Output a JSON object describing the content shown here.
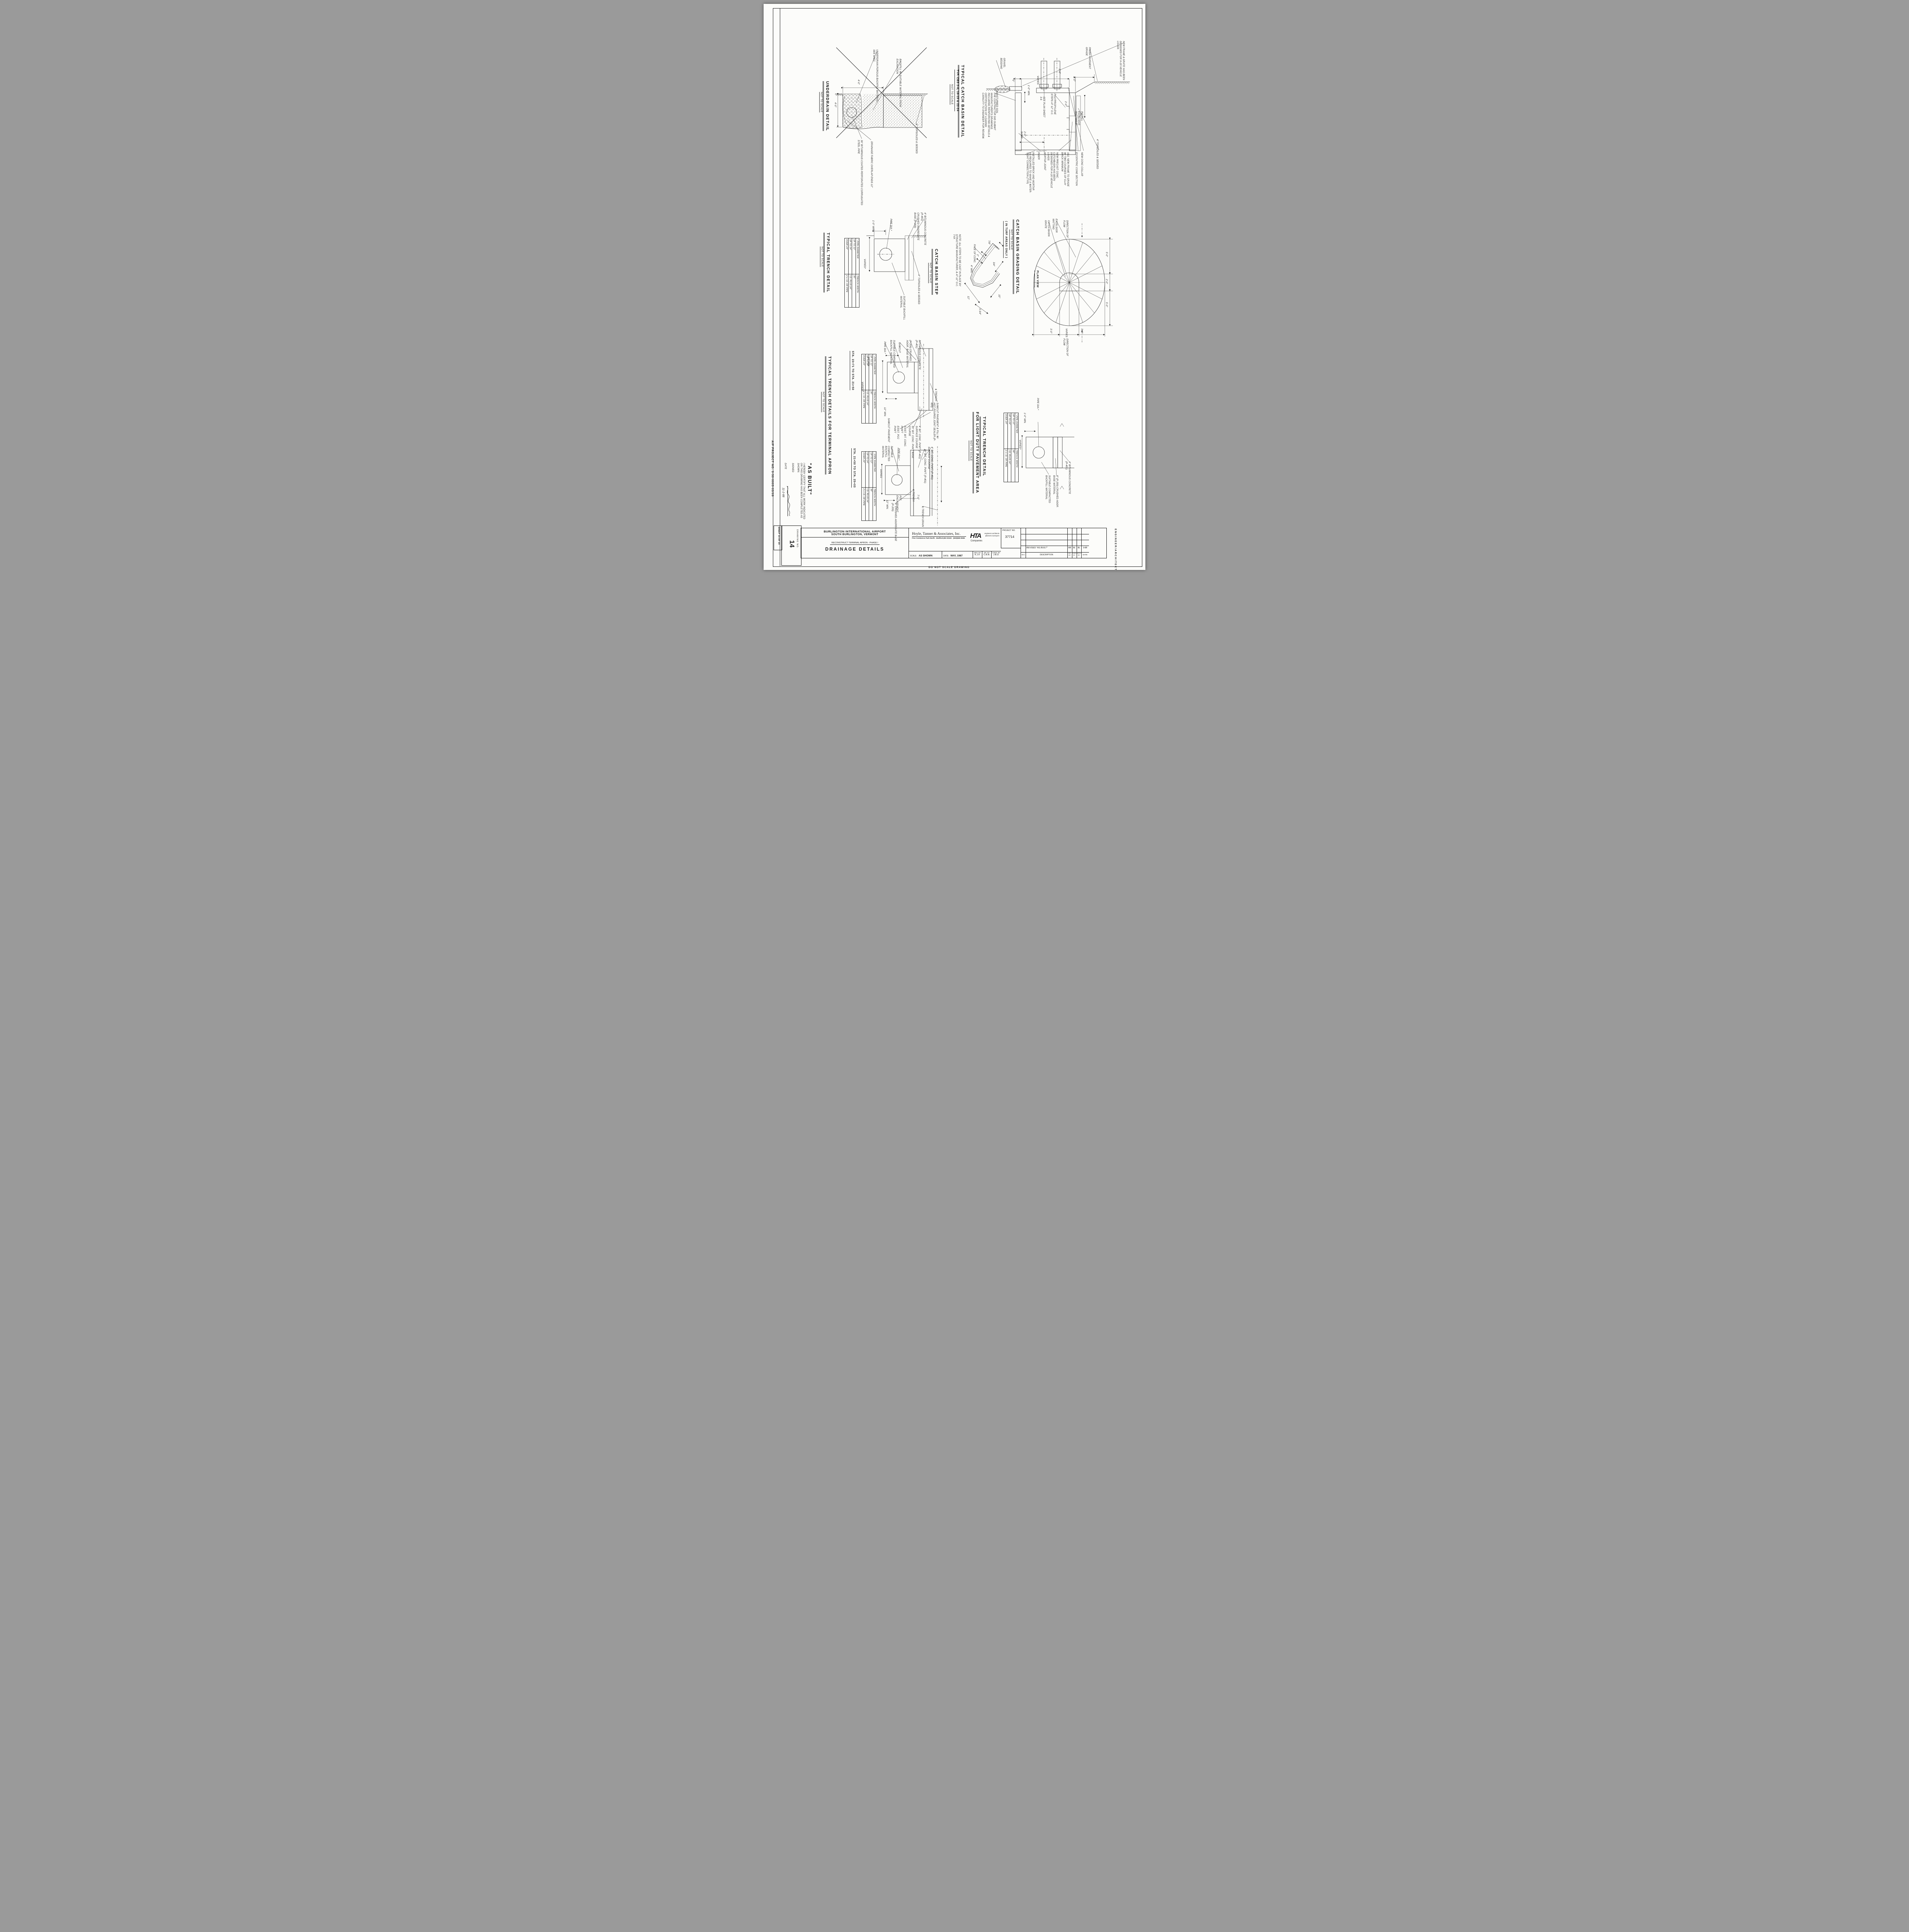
{
  "sheet": {
    "do_not_scale": "DO NOT SCALE DRAWING",
    "engineer_architect": "ENGINEER/ARCHITECT",
    "aip_project_no": "AIP PROJECT NO. 3-50-0005-03/09",
    "sheet_no": "SHEET 14 OF 23",
    "drawing_no_label": "DRAWING NO.",
    "drawing_no": "14"
  },
  "title_block": {
    "owner_line1": "BURLINGTON INTERNATIONAL AIRPORT",
    "owner_line2": "SOUTH BURLINGTON, VERMONT",
    "project": "RECONSTRUCT TERMINAL APRON - PHASE I",
    "sheet_title": "DRAINAGE DETAILS",
    "firm_name": "Hoyle, Tanner & Associates, Inc.",
    "firm_address": "Five Commerce Park North · Bedford,NH 03102 · (603)669-5555",
    "logo": "HTA",
    "logo_sub": "Companies",
    "services": "engineers architects planners surveyors",
    "scale_label": "SCALE:",
    "scale_value": "AS SHOWN",
    "date_label": "DATE:",
    "date_value": "MAY, 1987",
    "des_label": "DES. BY",
    "des_value": "K.J.F.",
    "dr_label": "DR. BY",
    "dr_value": "C.B.B.",
    "chkd_label": "CHKD. BY",
    "chkd_value": "J.B.D.",
    "project_no_label": "PROJECT NO.",
    "project_no": "37714",
    "rev_entry": {
      "rev": "",
      "description": "REVISED \"AS BUILT\"",
      "dr": "RB",
      "chkd": "BL",
      "appd": "BL",
      "date": "9-88"
    },
    "rev_headers": {
      "rev": "REV.",
      "description": "DESCRIPTION",
      "dr": "DR. BY",
      "chkd": "CHKD. BY",
      "appd": "APPD. BY",
      "date": "DATE"
    }
  },
  "as_built": {
    "heading": "\"AS BUILT\"",
    "certification": "I HEREBY CERTIFY THAT ALL WORK INDICATED ON THIS DRAWING HAS BEEN COMPLETED AS SHOWN.",
    "signed_label": "SIGNED",
    "date_label": "DATE",
    "date_value": "11-2-88"
  },
  "trench_table": {
    "star": "*",
    "col_pipe": "PIPE DIAMETER",
    "col_width": "TRENCH WIDTH",
    "rows": [
      [
        "UP TO 12\"",
        "36\""
      ],
      [
        "UP TO 24\"",
        "I.D. PLUS 24\""
      ],
      [
        "OVER 24\"",
        "2 x I.D. OF PIPE"
      ]
    ]
  },
  "underdrain": {
    "title": "UNDERDRAIN DETAIL",
    "scale_note": "NOT TO SCALE",
    "labels": {
      "porous_backfill": "UNDERDRAIN POROUS BACKFILL MATERIAL, SEE SPEC.",
      "suitable_backfill": "BACKFILL W/ SUITABLE MATERIAL FROM EXCAVATION",
      "pipe": "36\" BITUMINOUS COATED PERFORATED CORRUGATED STEEL PIPE",
      "fabric": "DRAINAGE FABRIC OVERLAP ENDS 12\"",
      "topsoil": "4\" TOPSOILED & SEEDED",
      "dim_width": "4'-0\"",
      "dim_depth": "4'-0\""
    }
  },
  "catch_basin": {
    "title": "TYPICAL CATCH BASIN DETAIL",
    "subtitle": "TYP. CBS 2-6, 16-19 & 22-24",
    "scale_note": "NOT TO SCALE",
    "note": "THE CONTRACTOR DID SUBMIT MANUFACTURER'S DRAWINGS INCLUDING REINFORCING DETAILS & CERTIFICATION OF LOADING CAPACITY TO ENGINEER FOR REVIEW.",
    "labels": {
      "gravel_bedding": "GRAVEL BEDDING",
      "undisturbed_soil": "UNDISTURBED SOIL",
      "finish_grade": "FINISH PAVEMENT GRADE",
      "new_frame": "NEW FRAME & GRATE HAS BEEN DESIGNED FOR H-20 VEHICLE LOADS",
      "install_matting": "INSTALL EXCELSIOR MATTING 3\"",
      "see_plan": "SEE PLAN SHEET 3-6",
      "steps": "POLYPROPYLENE STEPS AT 12\" O.C.",
      "installed_brick": "INSTALLED BRICK AND MORTAR AS REQUIRED TO MAKE A WATER-TIGHT CONNECTION (TYP)",
      "riser": "RISER",
      "mortar_joint": "MORTAR JOINT",
      "precast": "NEW PRECAST CONC. CATCHBASIN HAS BEEN DESIGNED FOR H-20 VEHICLE LOADS",
      "adj_frame": "ADJ. NEW FRAME TO GRADE W/ TWO COURSES OF CLAY BRICK MINIMUM",
      "eccentric": "ECCENTRIC CONE SECTION",
      "collar": "NEW CONC COLLAR",
      "topsoil": "4\" TOPSOILED & SEEDED",
      "dim_5": "5\"",
      "dim_varies": "VARIES",
      "dim_2_6": "2'-6\"",
      "dim_1_0_min": "1'-0\" MIN.",
      "dim_1_0": "1'-0\"",
      "dim_2_0": "2'-0\"",
      "dim_sump": "2'-0\" SUMP"
    }
  },
  "trench_detail": {
    "title": "TYPICAL TRENCH DETAIL",
    "scale_note": "NOT TO SCALE",
    "labels": {
      "pipe_dia": "PIPE DIA.*",
      "min": "1'-0\" MIN.",
      "varies": "VARIES*",
      "backfill": "SUITABLE BACKFILL MATERIAL",
      "topsoil": "4\" TOPSOILED & SEEDED",
      "bituminous": "4\" BITUMINOUS CONCRETE (P-401)",
      "aggregate": "CRUSHED AGGREGATE BASE (P-209)"
    }
  },
  "cb_step": {
    "title": "CATCH BASIN STEP",
    "scale_note": "NOT TO SCALE",
    "note": "NOTE: ALL STEPS TO BE CAST IN PLACE BY STRUCTURE MANUFACTURER, & AT 12\" O.C. TYP.",
    "labels": {
      "face": "FACE OF CONC.",
      "d1": "7/8\"",
      "d2": "2\"",
      "d3": "4\" MIN.",
      "d4": "3/4\"",
      "d5": "12\"",
      "d6": "3 3/4\"",
      "d7": "10\""
    }
  },
  "cb_grading": {
    "title": "CATCH BASIN GRADING DETAIL",
    "scale_note": "NOT TO SCALE",
    "subtitle": "( IN TURF AREAS ONLY )",
    "labels": {
      "grate": "CATCH BASIN GRATE",
      "matting": "EXCELSIOR MATTING",
      "flow_top": "DIRECTION OF FLOW",
      "flow_bottom": "DIRECTION OF FLOW",
      "plan_view": "PLAN VIEW",
      "dim_5a": "5'-0\"",
      "dim_2": "2'-0\"",
      "dim_5b": "5'-0\"",
      "dim_3a": "3'-0\"",
      "dim_varies": "VARIES",
      "dim_3b": "3'-0\""
    }
  },
  "apron": {
    "title": "TYPICAL TRENCH DETAILS FOR TERMINAL APRON",
    "scale_note": "NOT TO SCALE",
    "sta1": "STA. 15+71 TO STA. 21+50",
    "sta2": "STA. 21+50 TO STA. 25+03",
    "labels_a": {
      "min12": "12\" MIN.",
      "min12b": "12\" MIN.",
      "varies": "VARIES*",
      "pipe_dia": "PIPE DIA.*",
      "backfill": "SUITABLE COMPACTED BACKFILL MATERIAL",
      "sawcut": "SAWCUT",
      "aggregate": "(P-209) CRUSHED AGGR. BASE MATERIAL",
      "bituminous": "BITUMINOUS CONCRETE (P-401)",
      "sawcut_fill": "SAWCUT PAVEMENT & FILL W/ HOT POURED JOINT SEALER (P-605)",
      "cl_trench": "℄ TRENCH",
      "sawcut_pvmt": "SAWCUT PAVEMENT",
      "surface": "4\" BIT. CONC. PVM'T (P-401) SURFACE COURSE",
      "base": "10\" BIT. CONC. PVM'T BASE COURSE",
      "exist_bit": "EXIST. BIT. CONC. PVM'T",
      "exist_pcc": "EXIST. PCC PVM'T"
    },
    "labels_b": {
      "backfill": "SUITABLE COMPACTED BACKFILL MATERIAL",
      "pipe_dia": "PIPE DIA.*",
      "varies": "VARIES",
      "min12": "12\" MIN.",
      "aggregate": "6\" CRUSHED AGGREGATE BASE (P-209)",
      "pcc": "PCC ENCASEMENT",
      "cl_trench": "℄ TRENCH",
      "dim_7": "7'-0\"",
      "cl_drain": "℄ TRENCH DRAIN",
      "surface": "4\" BIT. CONC. PVM'T (P-401) SURFACE COURSE",
      "base": "10\" BIT. CONC. PVM'T (P-401)"
    }
  },
  "light_duty": {
    "title_1": "TYPICAL TRENCH DETAIL",
    "title_2": "FOR LIGHT DUTY PAVEMENT AREA",
    "scale_note": "NOT TO SCALE",
    "labels": {
      "pipe_dia": "PIPE DIA.*",
      "min": "1'-0\" MIN.",
      "varies": "VARIES*",
      "backfill": "SUITABLE COMPACTED BACKFILL MATERIAL",
      "aggregate": "8\" (P-209) CRUSHED AGGR. BASE MATERIAL",
      "bituminous": "4\" BITUMINOUS CONCRETE (P-401)"
    }
  }
}
